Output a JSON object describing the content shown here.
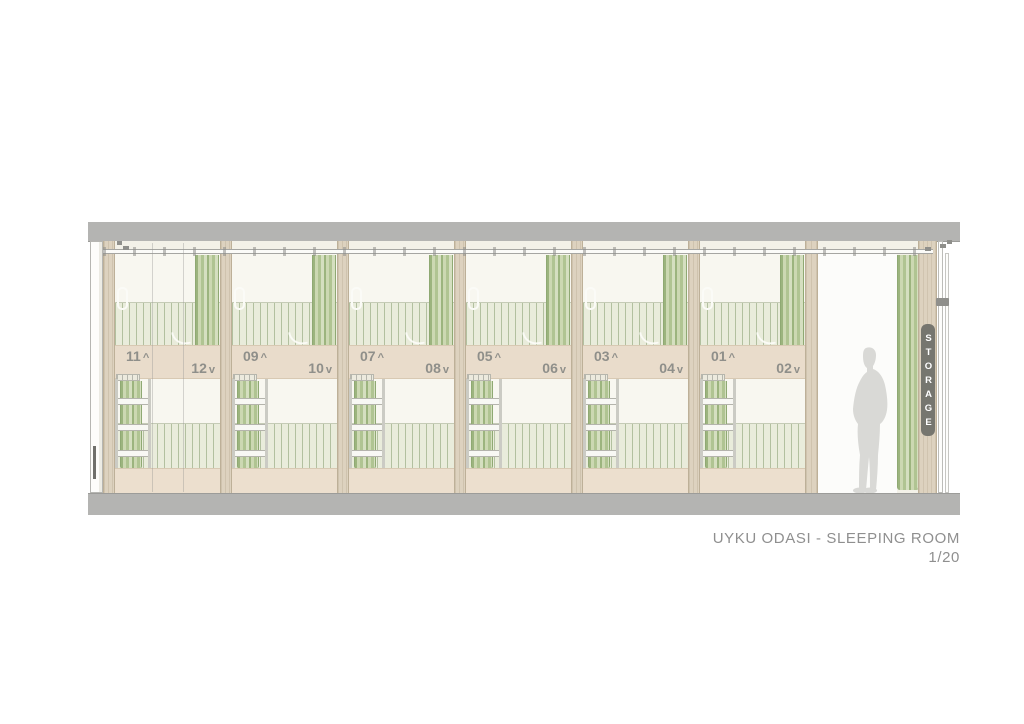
{
  "drawing": {
    "title": "UYKU ODASI - SLEEPING ROOM",
    "scale": "1/20",
    "storage_label": "STORAGE",
    "bays": [
      {
        "upper_no": "11",
        "upper_dir": "^",
        "lower_no": "12",
        "lower_dir": "v"
      },
      {
        "upper_no": "09",
        "upper_dir": "^",
        "lower_no": "10",
        "lower_dir": "v"
      },
      {
        "upper_no": "07",
        "upper_dir": "^",
        "lower_no": "08",
        "lower_dir": "v"
      },
      {
        "upper_no": "05",
        "upper_dir": "^",
        "lower_no": "06",
        "lower_dir": "v"
      },
      {
        "upper_no": "03",
        "upper_dir": "^",
        "lower_no": "04",
        "lower_dir": "v"
      },
      {
        "upper_no": "01",
        "upper_dir": "^",
        "lower_no": "02",
        "lower_dir": "v"
      }
    ],
    "colors": {
      "slab": "#b4b4b2",
      "wood": "#ddd2bf",
      "band": "#e9dccb",
      "panel": "#e9ecdb",
      "panel_stripe": "#b2c09f",
      "curtain_dark": "#9cb47e",
      "curtain_light": "#ccd8b2",
      "label": "#8f8f8a",
      "figure": "#d9d9d6",
      "sign_bg": "#76766f",
      "title_text": "#8f8f8f"
    }
  }
}
